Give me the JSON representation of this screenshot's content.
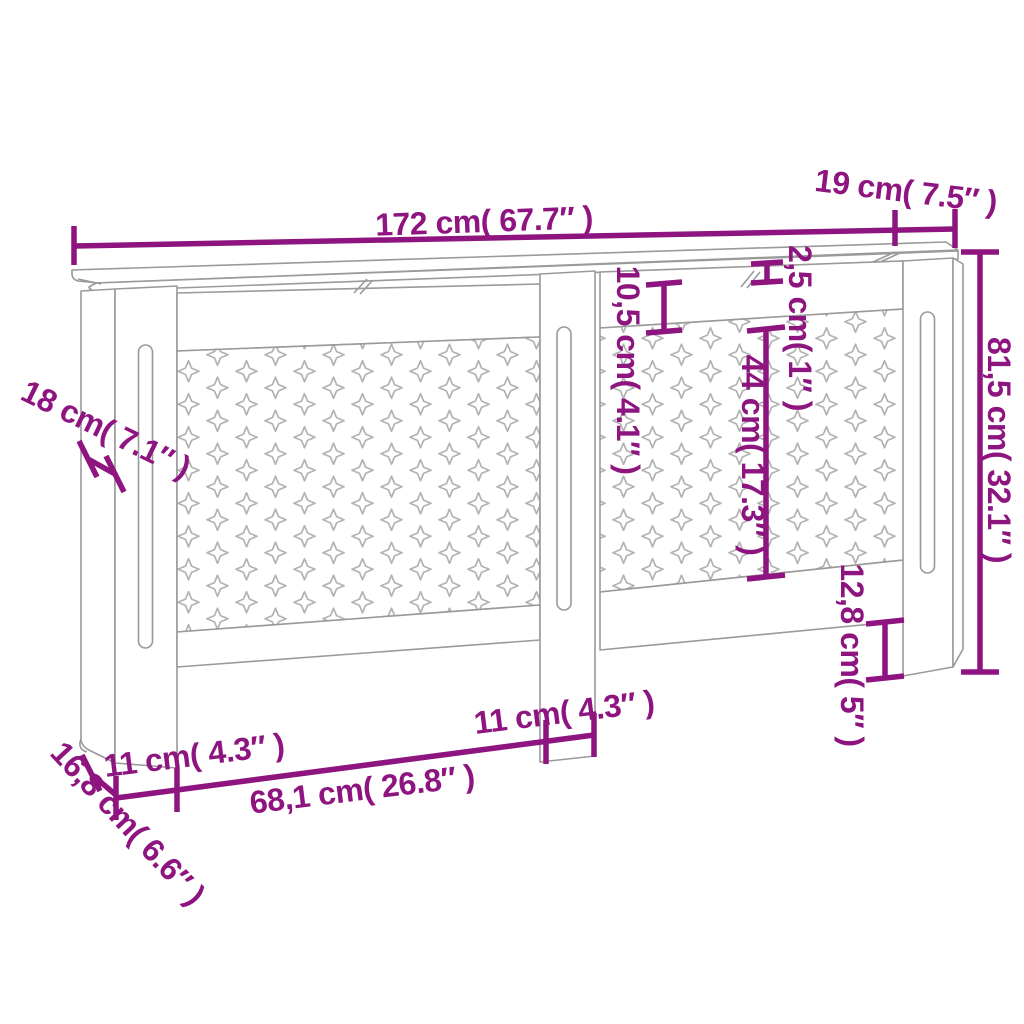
{
  "diagram": {
    "kind": "product dimension drawing",
    "subject": "radiator cover cabinet with cross lattice panels",
    "units": [
      "cm",
      "inches"
    ]
  },
  "colors": {
    "annotation": "#8e1480",
    "line_art": "#9a9a9a",
    "lattice_pattern": "#b2b2b2",
    "background": "#ffffff"
  },
  "labels": {
    "total_width": "172 cm( 67.7″ )",
    "top_depth": "19 cm( 7.5″ )",
    "top_thickness": "2,5 cm( 1″ )",
    "top_rail_height": "10,5 cm( 4.1″ )",
    "lattice_height": "44 cm( 17.3″ )",
    "total_height": "81,5 cm( 32.1″ )",
    "side_width": "18 cm( 7.1″ )",
    "bottom_clearance": "12,8 cm( 5″ )",
    "left_stile_width": "11 cm( 4.3″ )",
    "center_stile_width": "11 cm( 4.3″ )",
    "lattice_width": "68,1 cm( 26.8″ )",
    "base_depth": "16,8 cm( 6.6″ )"
  }
}
